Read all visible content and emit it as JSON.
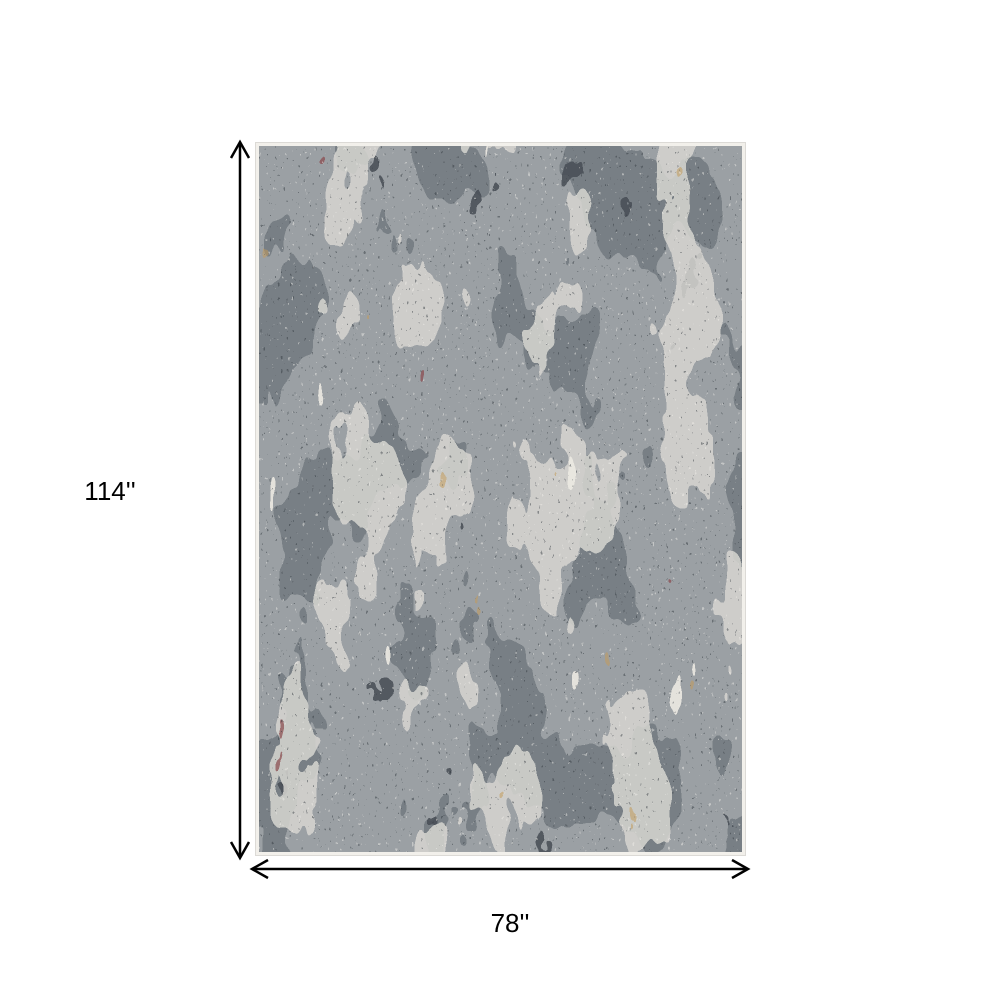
{
  "page": {
    "background_color": "#ffffff"
  },
  "diagram": {
    "type": "product-dimension-diagram",
    "height_label": "114''",
    "width_label": "78''",
    "arrow_color": "#000000",
    "label_color": "#000000"
  },
  "rug": {
    "description": "Gray abstract distressed area rug with cream, maroon and gold accents",
    "border_color": "#f2f0eb",
    "edge_line_color": "#dcdad6",
    "colors": {
      "base": "#9ba0a4",
      "slate": "#747b82",
      "dark": "#474e55",
      "light": "#d7d6d1",
      "cream": "#edeae3",
      "maroon": "#8a484e",
      "gold": "#c49c5c",
      "speckle_dark": "#2f343a",
      "speckle_light": "#f4f2ed"
    }
  }
}
